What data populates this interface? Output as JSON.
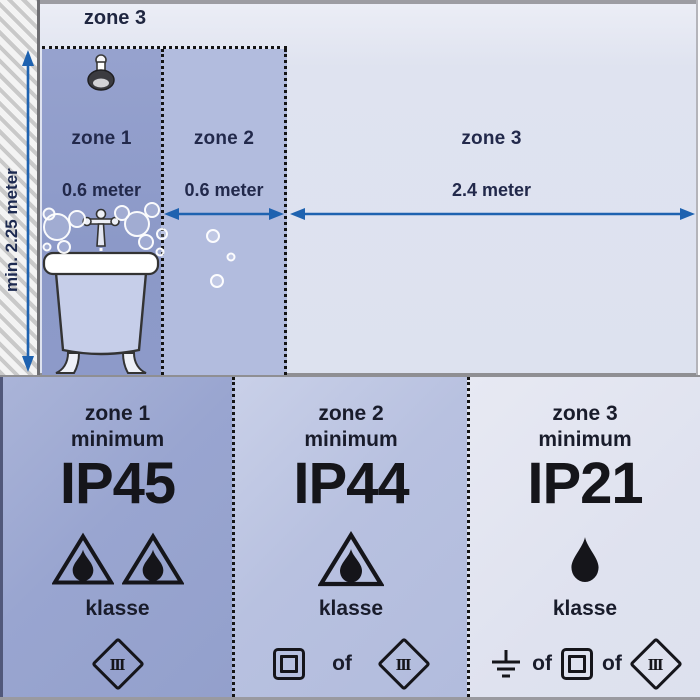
{
  "diagram": {
    "ceiling_zone_label": "zone 3",
    "wall_measure_label": "min. 2.25 meter",
    "zone1": {
      "name": "zone 1",
      "measure": "0.6 meter"
    },
    "zone2": {
      "name": "zone 2",
      "measure": "0.6 meter"
    },
    "zone3": {
      "name": "zone 3",
      "measure": "2.4 meter"
    },
    "icons": [
      "shower-head-icon",
      "bathtub-icon",
      "faucet-icon",
      "bubbles",
      "width-arrow-icon",
      "height-arrow-icon"
    ]
  },
  "panels": {
    "zone1": {
      "title": "zone 1",
      "minimum": "minimum",
      "ip": "IP45",
      "klasse": "klasse",
      "class_numeral": "III",
      "icons": [
        "drop-triangle-icon",
        "drop-triangle-icon",
        "class3-diamond-icon"
      ]
    },
    "zone2": {
      "title": "zone 2",
      "minimum": "minimum",
      "ip": "IP44",
      "klasse": "klasse",
      "or": "of",
      "class_numeral": "III",
      "icons": [
        "drop-triangle-icon",
        "class2-square-icon",
        "class3-diamond-icon"
      ]
    },
    "zone3": {
      "title": "zone 3",
      "minimum": "minimum",
      "ip": "IP21",
      "klasse": "klasse",
      "or": "of",
      "class_numeral": "III",
      "icons": [
        "drop-icon",
        "earth-ground-icon",
        "class2-square-icon",
        "class3-diamond-icon"
      ]
    }
  },
  "colors": {
    "zone1_fill": "#8d9ac9",
    "zone2_fill": "#b2bcde",
    "zone3_fill": "#dde2ef",
    "panel1_fill": "#99a5d0",
    "panel2_fill": "#b8c1e0",
    "panel3_fill": "#dfe2ef",
    "arrow_blue": "#1e62b0",
    "text_navy": "#22294b",
    "text_dark": "#15151a",
    "wall_hatch_gray": "#c9c9c9"
  }
}
